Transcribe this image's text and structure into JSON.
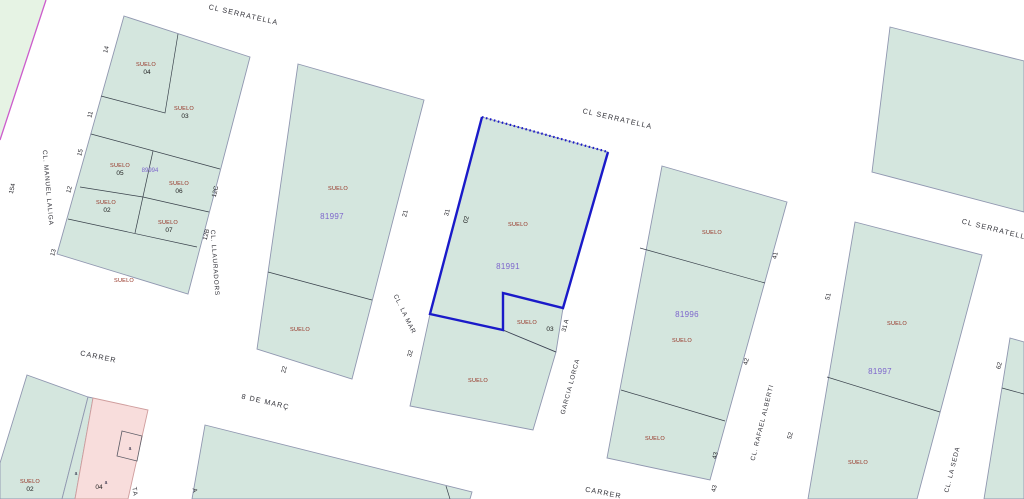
{
  "map": {
    "type": "cadastral-parcel-map",
    "selection_ref": "81991",
    "colors": {
      "parcel_fill": "#d4e6de",
      "edge_strip_fill": "#e6f3e4",
      "pink_fill": "#f8dddc",
      "selection_blue": "#1a1ac9",
      "ref_purple": "#7d66cc",
      "label_red": "#943021",
      "boundary_gray": "#9097b0",
      "sheet_magenta": "#cc5ccc"
    },
    "streets": {
      "serratella": "CL SERRATELLA",
      "manuel_laliga": "CL. MANUEL LALIGA",
      "llauradors": "CL. LLAURADORS",
      "la_mar": "CL. LA MAR",
      "garcia_lorca": "GARCIA LORCA",
      "rafael_alberti": "CL. RAFAEL ALBERTI",
      "la_seda": "CL. LA SEDA",
      "carrer": "CARRER",
      "vuit_de_marc": "8 DE MARÇ",
      "partial_a": "TA",
      "partial_b": "A"
    },
    "labels": {
      "suelo": "SUELO",
      "suba": "a"
    },
    "parcel_refs": {
      "block_a": "89994",
      "block_b": "81997",
      "block_c": "81991",
      "block_d": "81996",
      "block_e": "81997"
    },
    "parcel_numbers": {
      "a04": "04",
      "a03": "03",
      "a05": "05",
      "a06": "06",
      "a02": "02",
      "a07": "07",
      "c02": "02",
      "c03": "03",
      "bl02": "02",
      "bl04": "04"
    },
    "street_numbers": {
      "n154": "154",
      "n14": "14",
      "n11": "11",
      "n15": "15",
      "n12": "12",
      "n13": "13",
      "n12c": "12C",
      "n12b": "12B",
      "n21": "21",
      "n22": "22",
      "n31": "31",
      "n32": "32",
      "n31a": "31 A",
      "n41": "41",
      "n42": "42",
      "n43": "43",
      "n43b": "43",
      "n51": "51",
      "n52": "52",
      "n62": "62"
    }
  }
}
